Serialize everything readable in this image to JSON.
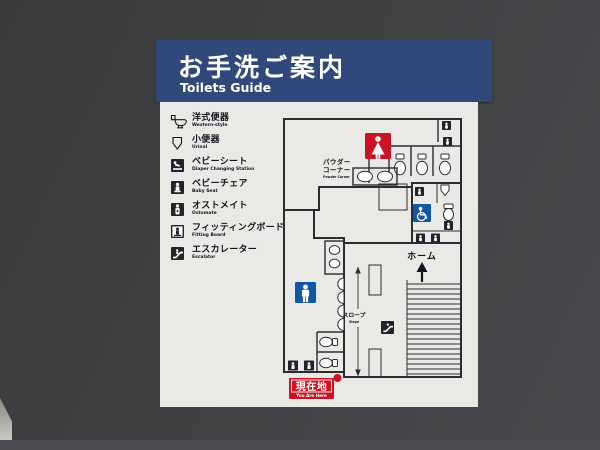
{
  "header": {
    "title_ja": "お手洗ご案内",
    "title_en": "Toilets Guide"
  },
  "legend": {
    "items": [
      {
        "label_ja": "洋式便器",
        "label_en": "Western-style",
        "icon": "western-toilet-icon"
      },
      {
        "label_ja": "小便器",
        "label_en": "Urinal",
        "icon": "urinal-icon"
      },
      {
        "label_ja": "ベビーシート",
        "label_en": "Diaper Changing Station",
        "icon": "diaper-changing-icon"
      },
      {
        "label_ja": "ベビーチェア",
        "label_en": "Baby Seat",
        "icon": "baby-seat-icon"
      },
      {
        "label_ja": "オストメイト",
        "label_en": "Ostomate",
        "icon": "ostomate-icon"
      },
      {
        "label_ja": "フィッティングボード",
        "label_en": "Fitting Board",
        "icon": "fitting-board-icon"
      },
      {
        "label_ja": "エスカレーター",
        "label_en": "Escalator",
        "icon": "escalator-icon"
      }
    ]
  },
  "map": {
    "powder_line1": "パウダー",
    "powder_line2": "コーナー",
    "powder_en": "Powder Corner",
    "platform_ja": "ホーム",
    "slope_ja": "スロープ",
    "slope_en": "Slope",
    "here_ja": "現在地",
    "here_en": "You Are Here",
    "icons": {
      "womens_toilet": "woman-icon",
      "mens_toilet": "man-icon",
      "accessible": "wheelchair-icon",
      "escalator": "escalator-icon",
      "platform_direction": "up-arrow-icon",
      "stairs": "stairs-treads"
    }
  },
  "colors": {
    "wall": "#3e4042",
    "header_bg": "#2f4a7a",
    "header_text": "#ffffff",
    "board": "#eae9e5",
    "womens_area": "#eec4ae",
    "mens_area": "#afb7d0",
    "accent_red": "#cd1225",
    "accent_blue": "#0f57a8",
    "wall_line": "#2c2c34",
    "pillar_gray": "#84858a",
    "legend_text": "#14141f"
  }
}
